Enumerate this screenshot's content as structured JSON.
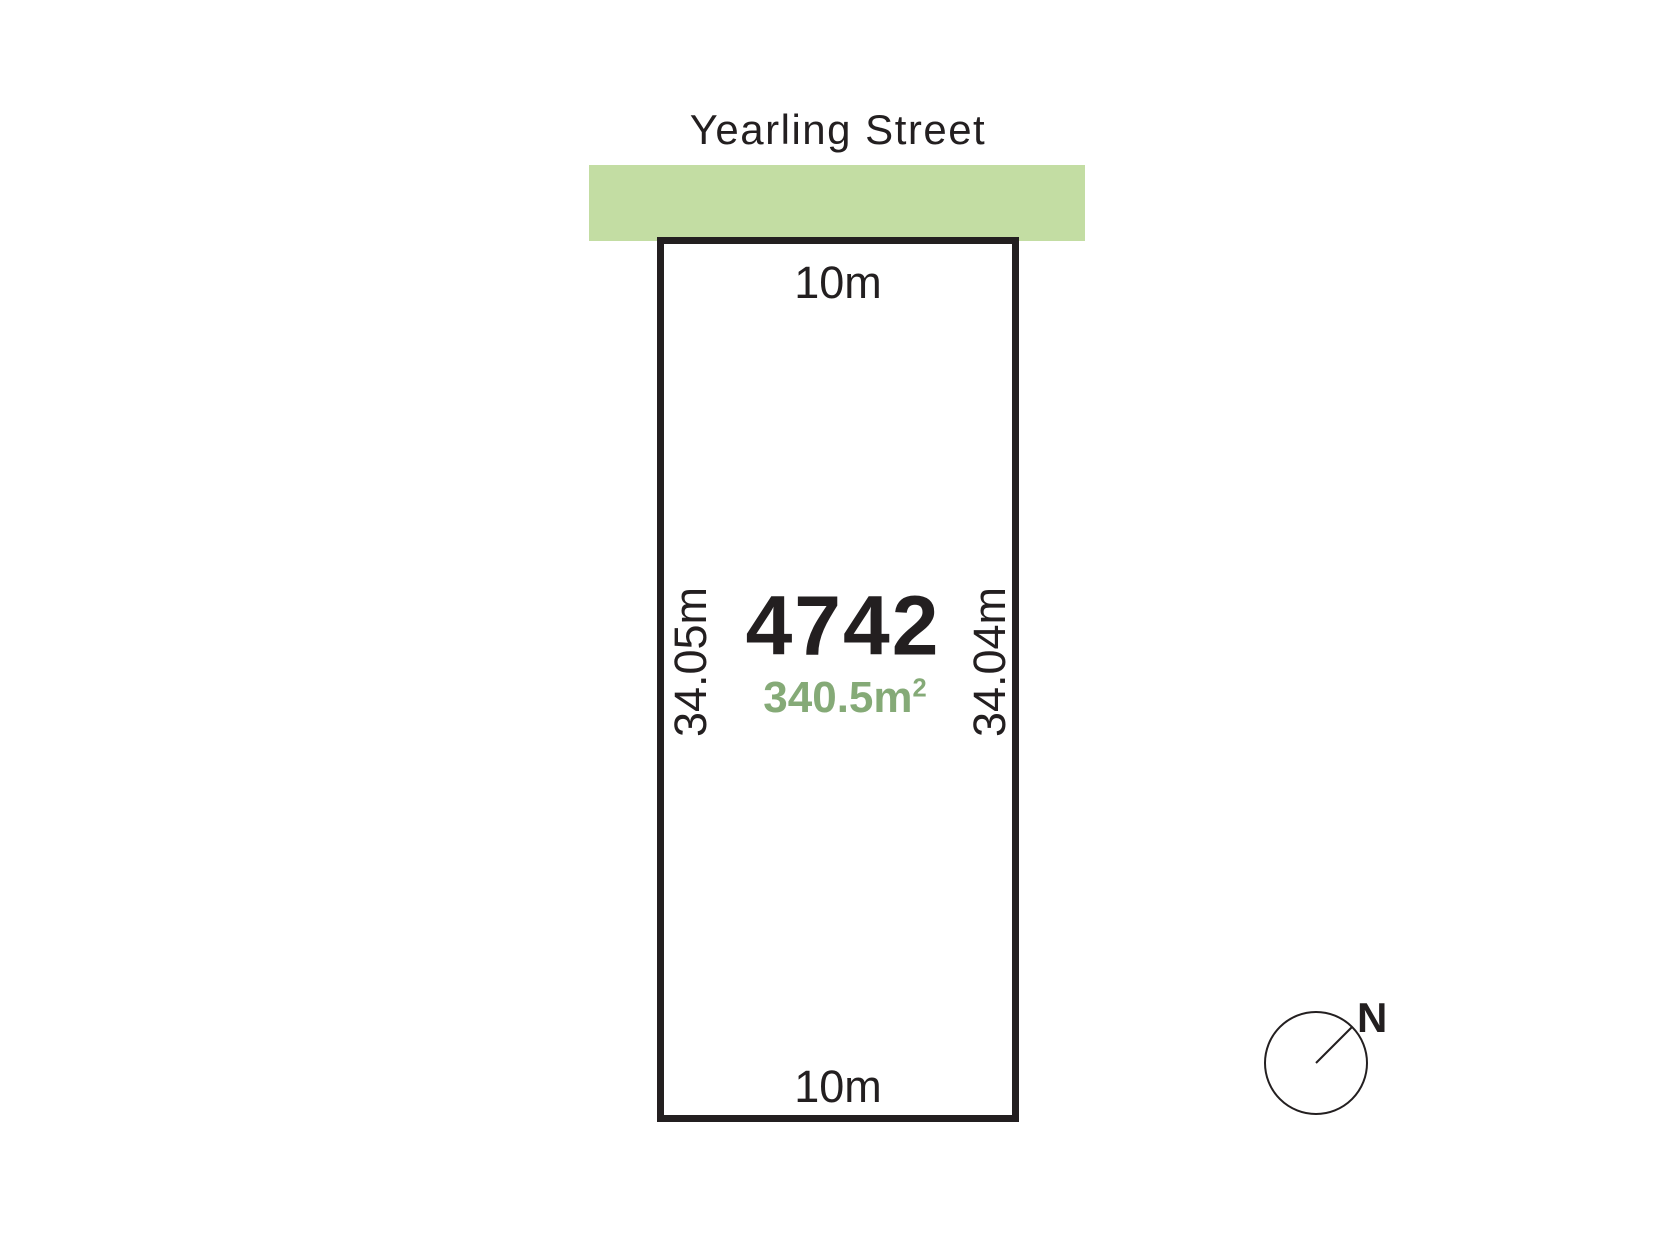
{
  "street": {
    "name": "Yearling Street"
  },
  "lot": {
    "number": "4742",
    "area_value": "340.5m",
    "area_superscript": "2",
    "frontage_top": "10m",
    "frontage_bottom": "10m",
    "depth_left": "34.05m",
    "depth_right": "34.04m"
  },
  "compass": {
    "north_label": "N"
  },
  "colors": {
    "street_fill": "#c3dda3",
    "area_text": "#85aa77",
    "ink": "#231f20"
  }
}
